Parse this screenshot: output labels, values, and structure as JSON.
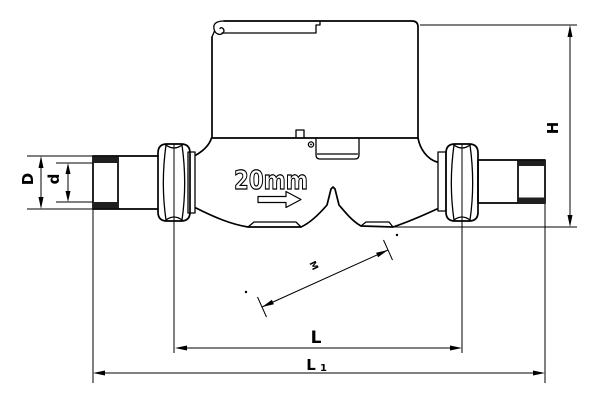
{
  "labels": {
    "outer_diameter": "D",
    "bore_diameter": "d",
    "height": "H",
    "length": "L",
    "overall_length_base": "L",
    "overall_length_subscript": "1",
    "nominal_size": "20mm",
    "diagonal_mark": "M"
  },
  "colors": {
    "line": "#000000",
    "background": "#ffffff",
    "thread_fill": "#1f1f1f"
  }
}
